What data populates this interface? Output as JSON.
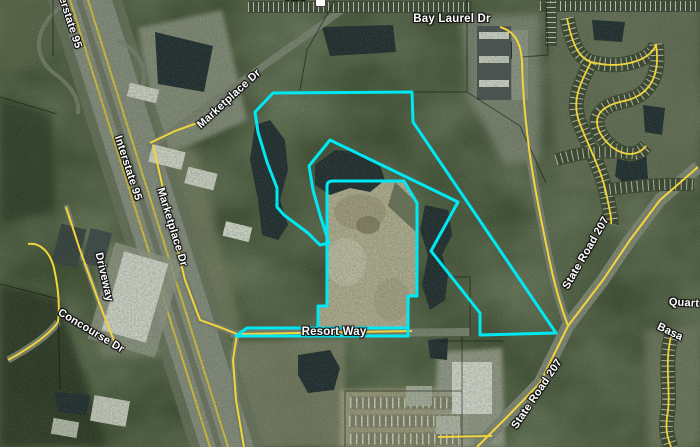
{
  "map": {
    "type": "aerial-parcel-viewer",
    "colors": {
      "parcel_boundary": "#00e8f4",
      "road_centerline": "#f2d43c",
      "water": "#18222e",
      "label_text": "#ffffff",
      "label_halo": "#141414"
    },
    "road_labels": {
      "interstate_95_upper": "Interstate 95",
      "interstate_95_lower": "Interstate 95",
      "marketplace_dr_upper": "Marketplace Dr",
      "marketplace_dr_lower": "Marketplace Dr",
      "bay_laurel_dr": "Bay Laurel Dr",
      "driveway": "Driveway",
      "concourse_dr": "Concourse Dr",
      "resort_way": "Resort Way",
      "state_road_207_upper": "State Road 207",
      "state_road_207_lower": "State Road 207",
      "quart_partial": "Quart",
      "basa_partial": "Basa",
      "ave_partial": "Ave"
    }
  }
}
